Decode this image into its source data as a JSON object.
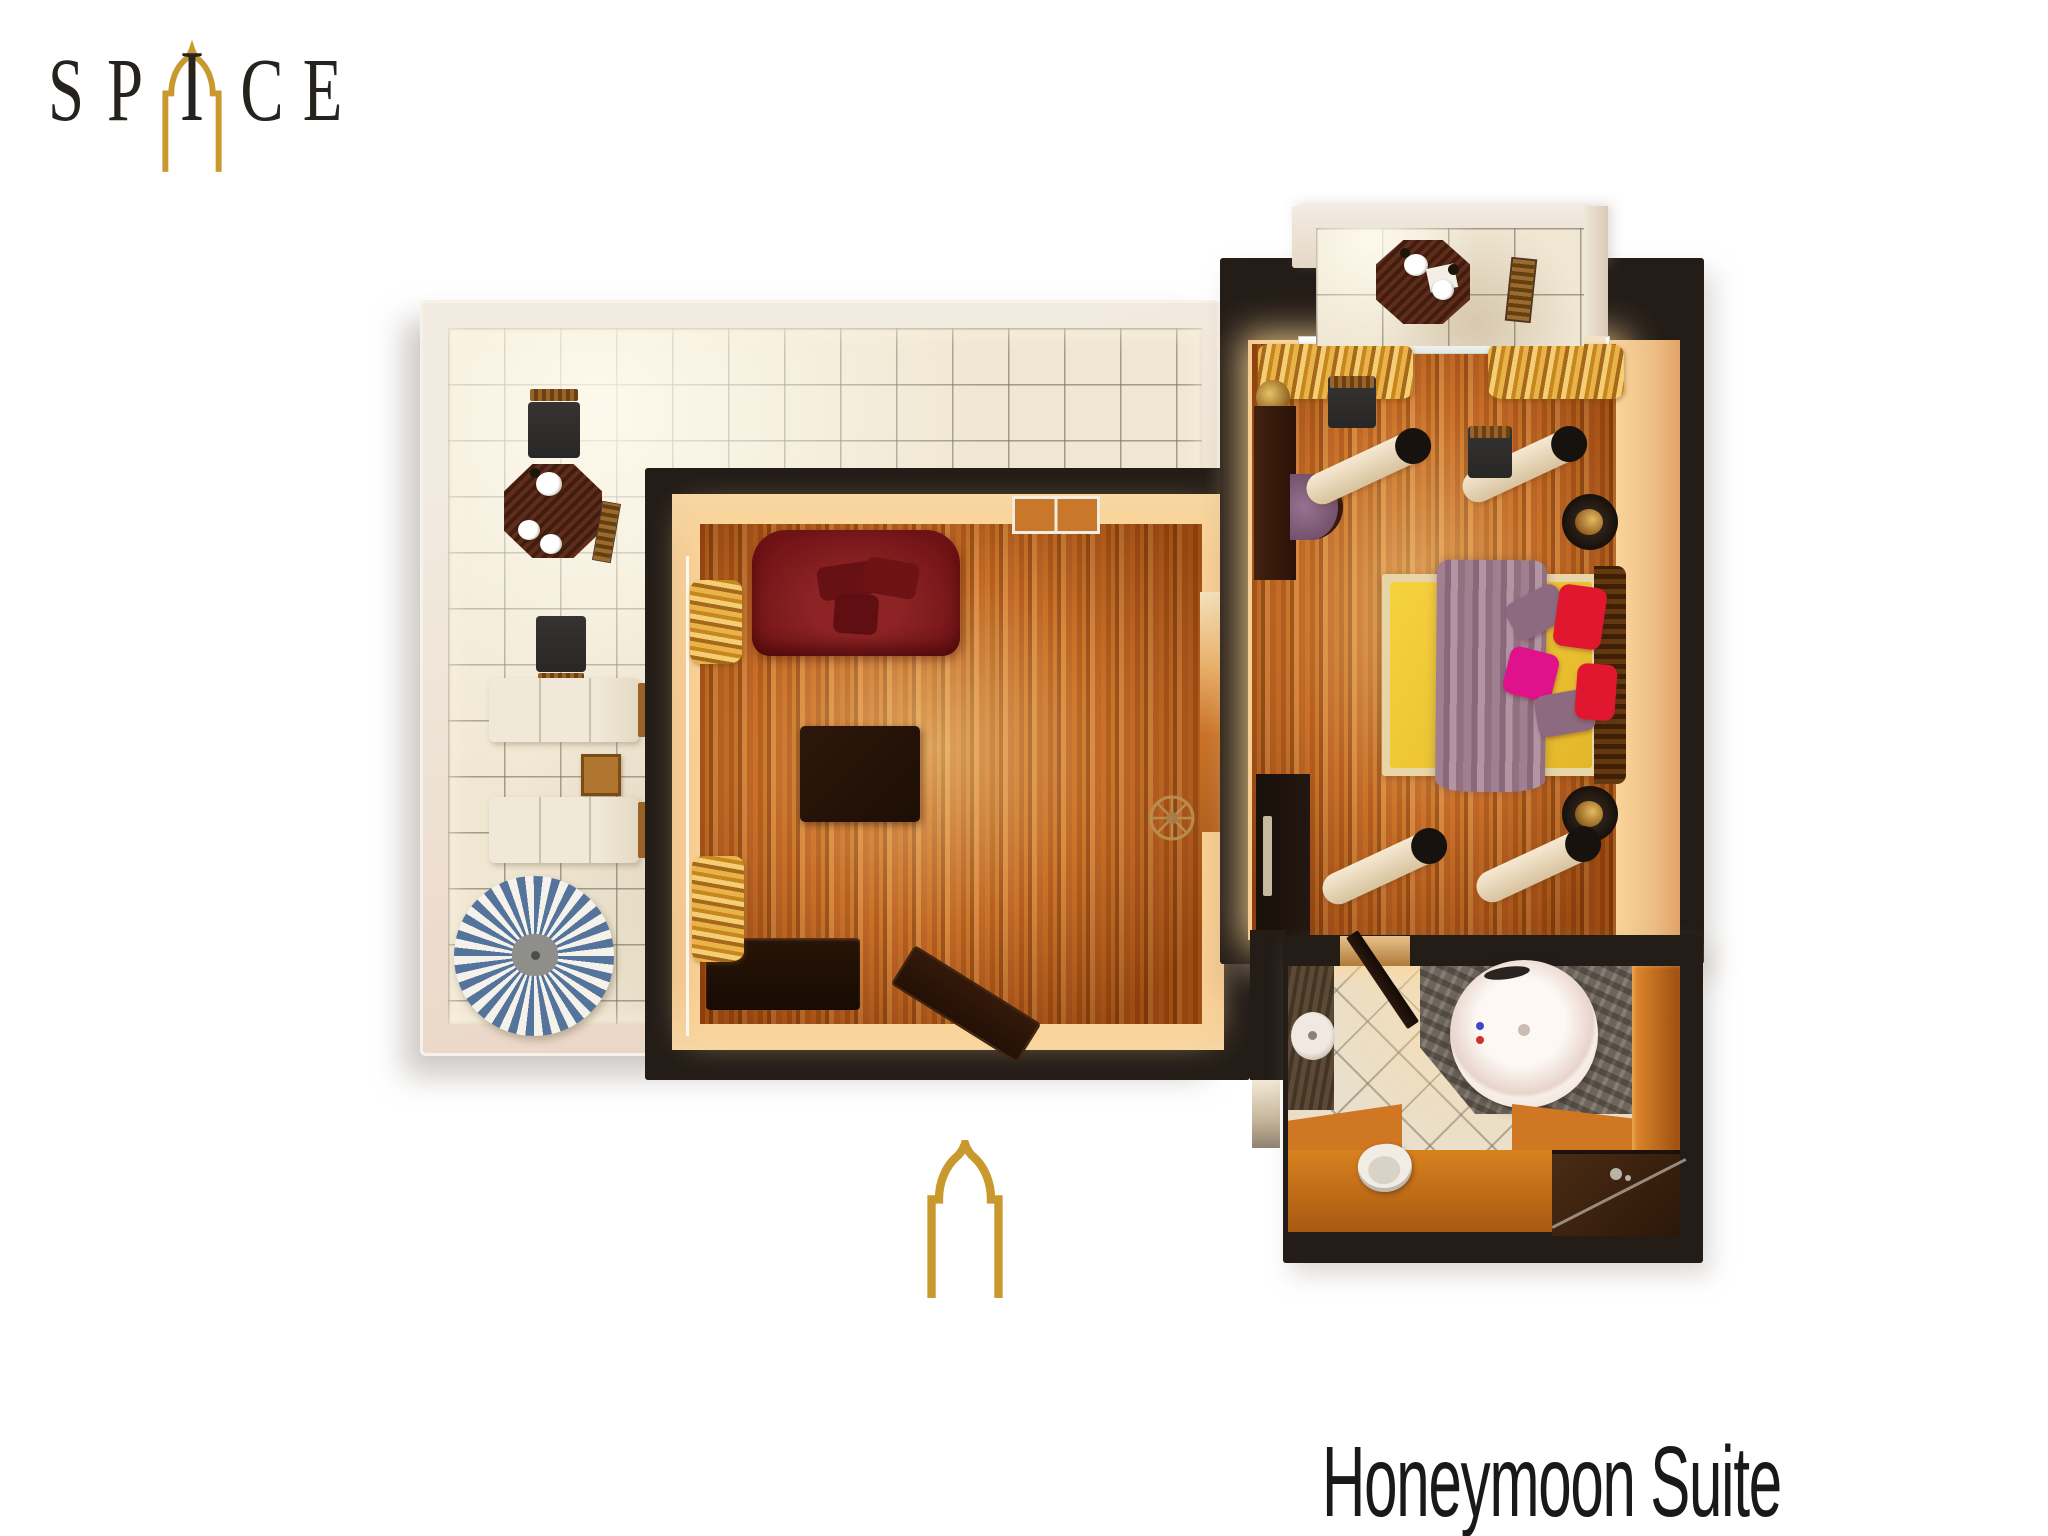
{
  "brand": {
    "letters": [
      "S",
      "P",
      "I",
      "C",
      "E"
    ]
  },
  "title": "Honeymoon Suite",
  "icons": {
    "logo_arch": "moorish-arch-icon",
    "entrance": "moorish-arch-door-icon",
    "living_room_ceiling": "ceiling-fan-icon"
  },
  "colors": {
    "accent_gold": "#c9992e",
    "ink": "#24211c",
    "wall_dark": "#231c17",
    "glow_warm": "#f7dcae",
    "terrace_tile": "#f0e7d3",
    "umbrella_blue": "#54749c",
    "bed_yellow": "#f0c835",
    "sofa_red": "#7c1618",
    "pillow_red": "#e0172f",
    "pillow_magenta": "#df128c",
    "pillow_purple": "#8d6a80",
    "throw_mauve": "#997a8a",
    "wood_orange": "#c2631c"
  },
  "plan": {
    "suite_name": "Honeymoon Suite",
    "rooms": [
      {
        "name": "roof-terrace",
        "floor": "cream tiles",
        "furniture": [
          "octagonal dining table",
          "two dark chairs",
          "folding chair",
          "two sun loungers",
          "wooden side table",
          "blue-white striped parasol"
        ]
      },
      {
        "name": "living-room",
        "floor": "wood parquet",
        "furniture": [
          "dark red sofa",
          "dark coffee table",
          "low bench",
          "angled chaise",
          "gold curtains",
          "ceiling fan",
          "terrace door"
        ]
      },
      {
        "name": "bedroom",
        "floor": "wood parquet",
        "furniture": [
          "double bed with yellow cover and mauve throw",
          "wood headboard",
          "five pillows",
          "two round lamps",
          "four bolster cushions",
          "desk",
          "purple chair",
          "wardrobe",
          "gold curtains"
        ]
      },
      {
        "name": "balcony",
        "floor": "cream tiles",
        "furniture": [
          "octagonal bistro table",
          "two dark chairs",
          "folding chair"
        ]
      },
      {
        "name": "bathroom",
        "floor": "diagonal tiles",
        "furniture": [
          "round jacuzzi tub on stone deck",
          "washbasin counter",
          "toilet",
          "vanity with faucet",
          "shower corner",
          "swinging door"
        ]
      }
    ]
  }
}
